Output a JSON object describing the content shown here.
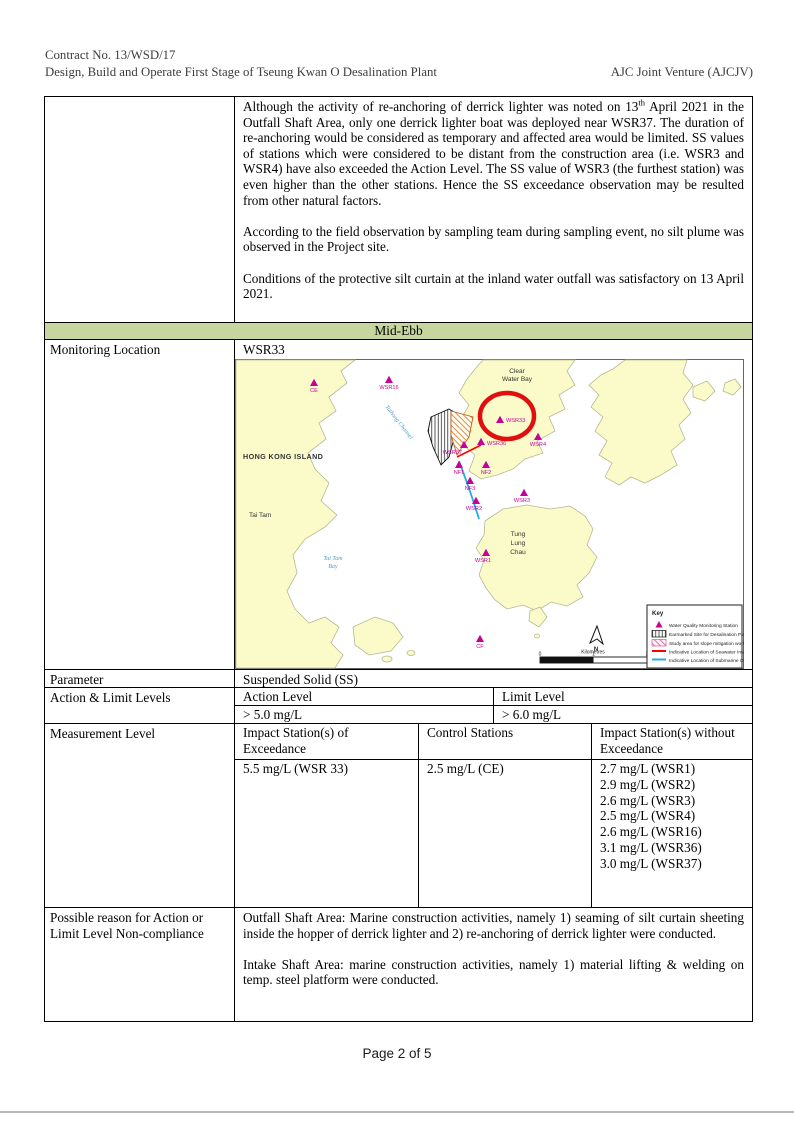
{
  "header": {
    "contract_no": "Contract No. 13/WSD/17",
    "project_title": "Design, Build and Operate First Stage of Tseung Kwan O Desalination Plant",
    "company": "AJC Joint Venture (AJCJV)"
  },
  "remarks": {
    "para1_a": "Although the activity of re-anchoring of derrick lighter was noted on 13",
    "para1_sup": "th",
    "para1_b": " April 2021 in the Outfall Shaft Area, only one derrick lighter boat was deployed near WSR37. The duration of re-anchoring would be considered as temporary and affected area would be limited. SS values of stations which were considered to be distant from the construction area (i.e. WSR3 and WSR4) have also exceeded the Action Level. The SS value of WSR3 (the furthest station) was even higher than the other stations. Hence the SS exceedance observation may be resulted from other natural factors.",
    "para2": "According to the field observation by sampling team during sampling event, no silt plume was observed in the Project site.",
    "para3": "Conditions of the protective silt curtain at the inland water outfall was satisfactory on 13 April 2021."
  },
  "tide_header": "Mid-Ebb",
  "monitoring": {
    "label": "Monitoring Location",
    "value": "WSR33"
  },
  "parameter": {
    "label": "Parameter",
    "value": "Suspended Solid (SS)"
  },
  "action_limit": {
    "label": "Action & Limit Levels",
    "action_label": "Action Level",
    "limit_label": "Limit Level",
    "action_value": "> 5.0 mg/L",
    "limit_value": "> 6.0 mg/L"
  },
  "measurement": {
    "label": "Measurement Level",
    "col1_header": "Impact Station(s) of Exceedance",
    "col2_header": "Control Stations",
    "col3_header": "Impact Station(s) without Exceedance",
    "impact_exceedance": "5.5 mg/L (WSR 33)",
    "control": "2.5 mg/L (CE)",
    "without_exceedance": [
      "2.7 mg/L (WSR1)",
      "2.9 mg/L (WSR2)",
      "2.6 mg/L (WSR3)",
      "2.5 mg/L (WSR4)",
      "2.6 mg/L (WSR16)",
      "3.1 mg/L (WSR36)",
      "3.0 mg/L (WSR37)"
    ]
  },
  "possible_reason": {
    "label": "Possible reason for Action or Limit Level Non-compliance",
    "para1": "Outfall Shaft Area: Marine construction activities, namely 1) seaming of silt curtain sheeting inside the hopper of derrick lighter and 2) re-anchoring of derrick lighter were conducted.",
    "para2": "Intake Shaft Area: marine construction activities, namely 1) material lifting & welding on temp. steel platform were conducted."
  },
  "map": {
    "region_labels": {
      "clear_water_bay": [
        "Clear",
        "Water Bay"
      ],
      "hong_kong_island": [
        "HONG KONG ISLAND"
      ],
      "tathong_channel": [
        "Tathong Channel"
      ],
      "tai_tam": [
        "Tai Tam"
      ],
      "tai_tam_bay": [
        "Tai Tam",
        "Bay"
      ],
      "tung_lung_chau": [
        "Tung",
        "Lung",
        "Chau"
      ]
    },
    "stations": [
      {
        "label": "CE"
      },
      {
        "label": "WSR16"
      },
      {
        "label": "WSR33"
      },
      {
        "label": "WSR4"
      },
      {
        "label": "WSR36"
      },
      {
        "label": "WSR37"
      },
      {
        "label": "NF1"
      },
      {
        "label": "NF2"
      },
      {
        "label": "NF3"
      },
      {
        "label": "WSR3"
      },
      {
        "label": "WSR2"
      },
      {
        "label": "WSR1"
      },
      {
        "label": "CF"
      }
    ],
    "north_label": "N",
    "scale": {
      "unit_label": "Kilometres",
      "ticks": [
        "0",
        "1",
        "2"
      ]
    },
    "key": {
      "title": "Key",
      "items": [
        {
          "label": "Water Quality Monitoring Station"
        },
        {
          "label": "Earmarked Site for Desalination Plant"
        },
        {
          "label": "Study area for slope mitigation works"
        },
        {
          "label": "Indicative Location of Seawater Intake"
        },
        {
          "label": "Indicative Location of Submarine Outfall"
        }
      ]
    }
  },
  "footer": {
    "page_label": "Page 2 of 5"
  },
  "colors": {
    "tide_header_bg": "#c6d69e",
    "station_marker": "#c8009b",
    "highlight_circle": "#e01010",
    "intake_line": "#ff0000",
    "outfall_line": "#29abe2",
    "land_fill": "#fbfbc9"
  }
}
